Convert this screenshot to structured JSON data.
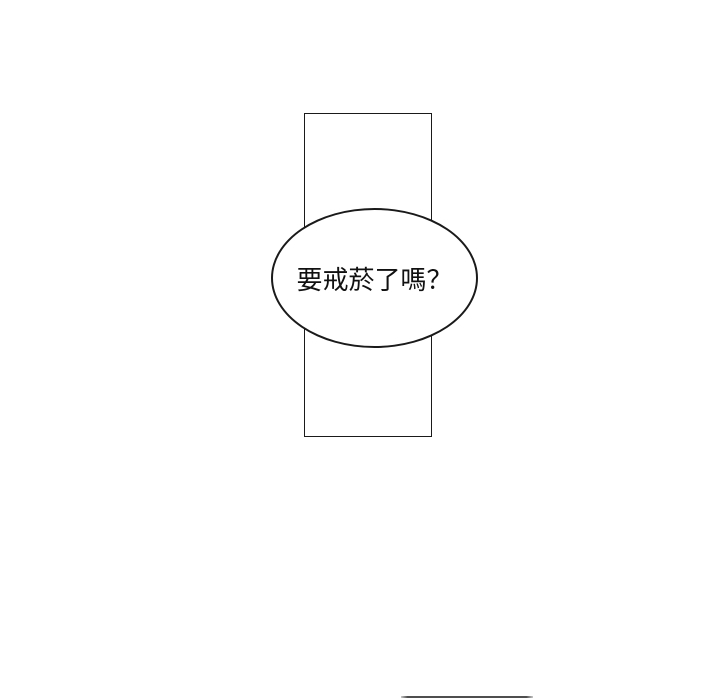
{
  "comic": {
    "speech_bubble_text": "要戒菸了嗎？"
  },
  "colors": {
    "background": "#ffffff",
    "line": "#1a1a1a",
    "bubble-fill": "#ffffff",
    "text": "#111111",
    "next-panel-line": "#4f4f4f"
  }
}
